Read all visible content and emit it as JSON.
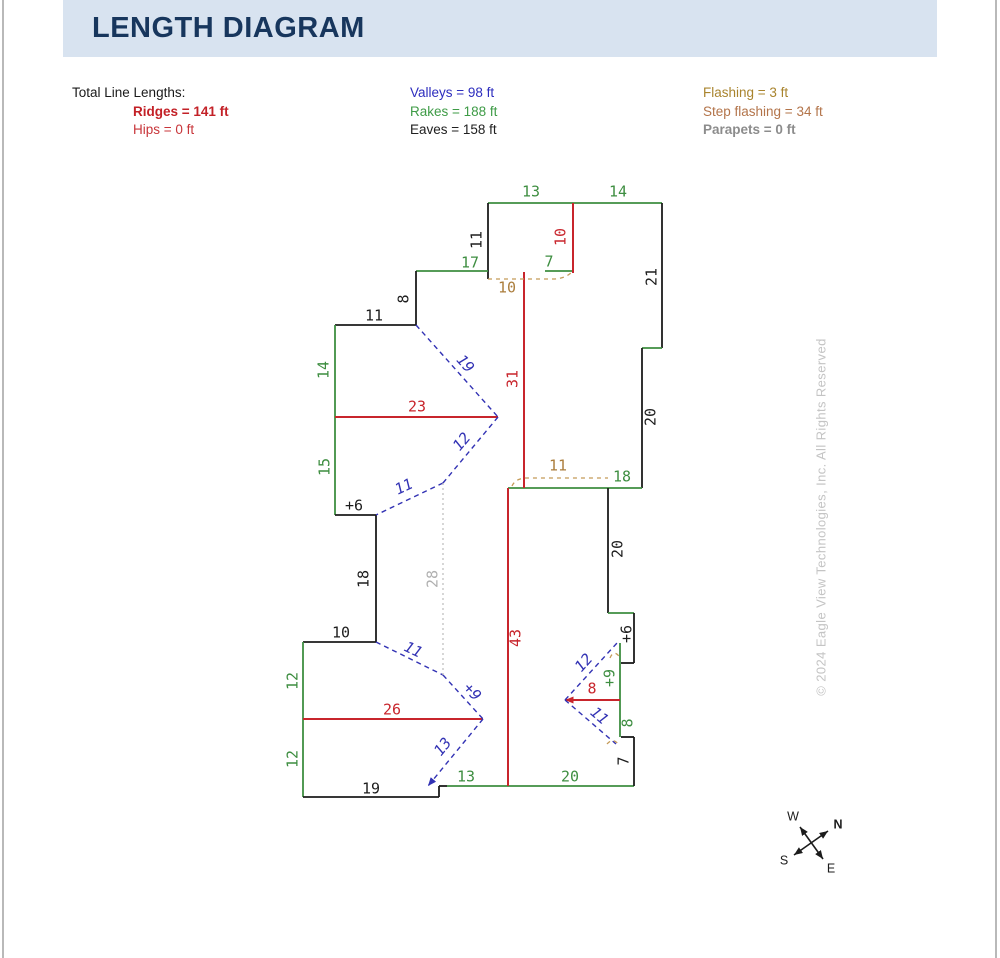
{
  "page": {
    "title": "LENGTH DIAGRAM"
  },
  "legend": {
    "columns": [
      {
        "x": 72,
        "header": "Total Line Lengths:",
        "indent": 61,
        "rows": [
          {
            "text": "Ridges = 141 ft",
            "color": "#c32127",
            "bold": true
          },
          {
            "text": "Hips = 0 ft",
            "color": "#c8353a",
            "bold": false
          }
        ]
      },
      {
        "x": 410,
        "header": "",
        "indent": 0,
        "rows": [
          {
            "text": "Valleys = 98 ft",
            "color": "#2d2dbe",
            "bold": false
          },
          {
            "text": "Rakes = 188 ft",
            "color": "#3e9b46",
            "bold": false
          },
          {
            "text": "Eaves = 158 ft",
            "color": "#202020",
            "bold": false
          }
        ]
      },
      {
        "x": 703,
        "header": "",
        "indent": 0,
        "rows": [
          {
            "text": "Flashing = 3 ft",
            "color": "#a9842e",
            "bold": false
          },
          {
            "text": "Step flashing = 34 ft",
            "color": "#b3744a",
            "bold": false
          },
          {
            "text": "Parapets = 0 ft",
            "color": "#8c8c8c",
            "bold": true
          }
        ]
      }
    ]
  },
  "colors": {
    "lines": {
      "eave": "#1c1c1c",
      "rake": "#3e8e41",
      "ridge": "#c8252c",
      "valley": "#3232b4",
      "step": "#c49a58",
      "hidden": "#bcbcbc",
      "compass": "#1c1c1c"
    },
    "labels": {
      "eave": "#1c1c1c",
      "rake": "#3e8e41",
      "ridge": "#c8252c",
      "valley": "#3232b4",
      "step": "#ab7d3c",
      "hidden": "#b0b0b0",
      "compass": "#1c1c1c",
      "watermark": "#c4c4c4"
    },
    "header_bg": "#d8e3f0",
    "title": "#17365d"
  },
  "diagram": {
    "segments": [
      {
        "kind": "rake",
        "x1": 488,
        "y1": 203,
        "x2": 573,
        "y2": 203
      },
      {
        "kind": "rake",
        "x1": 573,
        "y1": 203,
        "x2": 662,
        "y2": 203
      },
      {
        "kind": "eave",
        "x1": 488,
        "y1": 203,
        "x2": 488,
        "y2": 279
      },
      {
        "kind": "eave",
        "x1": 662,
        "y1": 203,
        "x2": 662,
        "y2": 348
      },
      {
        "kind": "rake",
        "x1": 642,
        "y1": 348,
        "x2": 662,
        "y2": 348
      },
      {
        "kind": "eave",
        "x1": 642,
        "y1": 348,
        "x2": 642,
        "y2": 488
      },
      {
        "kind": "rake",
        "x1": 416,
        "y1": 271,
        "x2": 488,
        "y2": 271
      },
      {
        "kind": "rake",
        "x1": 545,
        "y1": 271,
        "x2": 573,
        "y2": 271
      },
      {
        "kind": "eave",
        "x1": 416,
        "y1": 271,
        "x2": 416,
        "y2": 325
      },
      {
        "kind": "eave",
        "x1": 335,
        "y1": 325,
        "x2": 416,
        "y2": 325
      },
      {
        "kind": "rake",
        "x1": 335,
        "y1": 325,
        "x2": 335,
        "y2": 417
      },
      {
        "kind": "rake",
        "x1": 335,
        "y1": 417,
        "x2": 335,
        "y2": 515
      },
      {
        "kind": "eave",
        "x1": 335,
        "y1": 515,
        "x2": 376,
        "y2": 515
      },
      {
        "kind": "eave",
        "x1": 376,
        "y1": 515,
        "x2": 376,
        "y2": 642
      },
      {
        "kind": "eave",
        "x1": 303,
        "y1": 642,
        "x2": 376,
        "y2": 642
      },
      {
        "kind": "rake",
        "x1": 303,
        "y1": 642,
        "x2": 303,
        "y2": 719
      },
      {
        "kind": "rake",
        "x1": 303,
        "y1": 719,
        "x2": 303,
        "y2": 797
      },
      {
        "kind": "eave",
        "x1": 303,
        "y1": 797,
        "x2": 439,
        "y2": 797
      },
      {
        "kind": "eave",
        "x1": 439,
        "y1": 786,
        "x2": 439,
        "y2": 797
      },
      {
        "kind": "eave",
        "x1": 439,
        "y1": 786,
        "x2": 447,
        "y2": 786
      },
      {
        "kind": "rake",
        "x1": 447,
        "y1": 786,
        "x2": 508,
        "y2": 786
      },
      {
        "kind": "rake",
        "x1": 508,
        "y1": 786,
        "x2": 634,
        "y2": 786
      },
      {
        "kind": "rake",
        "x1": 508,
        "y1": 488,
        "x2": 642,
        "y2": 488
      },
      {
        "kind": "eave",
        "x1": 608,
        "y1": 488,
        "x2": 608,
        "y2": 613
      },
      {
        "kind": "rake",
        "x1": 608,
        "y1": 613,
        "x2": 634,
        "y2": 613
      },
      {
        "kind": "eave",
        "x1": 634,
        "y1": 613,
        "x2": 634,
        "y2": 663
      },
      {
        "kind": "eave",
        "x1": 621,
        "y1": 663,
        "x2": 634,
        "y2": 663
      },
      {
        "kind": "rake",
        "x1": 620,
        "y1": 643,
        "x2": 620,
        "y2": 737
      },
      {
        "kind": "eave",
        "x1": 621,
        "y1": 737,
        "x2": 634,
        "y2": 737
      },
      {
        "kind": "eave",
        "x1": 634,
        "y1": 737,
        "x2": 634,
        "y2": 786
      },
      {
        "kind": "ridge",
        "x1": 573,
        "y1": 203,
        "x2": 573,
        "y2": 273
      },
      {
        "kind": "ridge",
        "x1": 524,
        "y1": 272,
        "x2": 524,
        "y2": 488
      },
      {
        "kind": "ridge",
        "x1": 335,
        "y1": 417,
        "x2": 498,
        "y2": 417
      },
      {
        "kind": "ridge",
        "x1": 508,
        "y1": 488,
        "x2": 508,
        "y2": 786
      },
      {
        "kind": "ridge",
        "x1": 303,
        "y1": 719,
        "x2": 483,
        "y2": 719
      },
      {
        "kind": "ridge",
        "x1": 565,
        "y1": 700,
        "x2": 620,
        "y2": 700,
        "as": true
      },
      {
        "kind": "valley",
        "x1": 416,
        "y1": 325,
        "x2": 498,
        "y2": 417
      },
      {
        "kind": "valley",
        "x1": 498,
        "y1": 417,
        "x2": 443,
        "y2": 483
      },
      {
        "kind": "valley",
        "x1": 443,
        "y1": 483,
        "x2": 376,
        "y2": 515
      },
      {
        "kind": "valley",
        "x1": 376,
        "y1": 642,
        "x2": 443,
        "y2": 675
      },
      {
        "kind": "valley",
        "x1": 443,
        "y1": 675,
        "x2": 483,
        "y2": 719
      },
      {
        "kind": "valley",
        "x1": 483,
        "y1": 719,
        "x2": 428,
        "y2": 786,
        "ae": true
      },
      {
        "kind": "valley",
        "x1": 565,
        "y1": 700,
        "x2": 617,
        "y2": 643
      },
      {
        "kind": "valley",
        "x1": 565,
        "y1": 700,
        "x2": 616,
        "y2": 744
      },
      {
        "kind": "step",
        "path": "M488,279 L555,279 Q566,278 572,272"
      },
      {
        "kind": "step",
        "path": "M512,486 Q515,479 525,478 L608,478"
      },
      {
        "kind": "step",
        "path": "M610,658 Q614,648 621,659"
      },
      {
        "kind": "step",
        "path": "M607,744 Q613,737 619,745"
      },
      {
        "kind": "hidden",
        "x1": 443,
        "y1": 483,
        "x2": 443,
        "y2": 675
      }
    ],
    "labels": [
      {
        "text": "13",
        "x": 531,
        "y": 192,
        "kind": "rake"
      },
      {
        "text": "14",
        "x": 618,
        "y": 192,
        "kind": "rake"
      },
      {
        "text": "11",
        "x": 477,
        "y": 240,
        "kind": "eave",
        "rot": -90
      },
      {
        "text": "10",
        "x": 561,
        "y": 237,
        "kind": "ridge",
        "rot": -90
      },
      {
        "text": "17",
        "x": 470,
        "y": 263,
        "kind": "rake"
      },
      {
        "text": "7",
        "x": 549,
        "y": 262,
        "kind": "rake"
      },
      {
        "text": "10",
        "x": 507,
        "y": 288,
        "kind": "step"
      },
      {
        "text": "21",
        "x": 652,
        "y": 277,
        "kind": "eave",
        "rot": -90
      },
      {
        "text": "8",
        "x": 404,
        "y": 299,
        "kind": "eave",
        "rot": -90
      },
      {
        "text": "11",
        "x": 374,
        "y": 316,
        "kind": "eave"
      },
      {
        "text": "14",
        "x": 324,
        "y": 370,
        "kind": "rake",
        "rot": -90
      },
      {
        "text": "19",
        "x": 465,
        "y": 364,
        "kind": "valley",
        "rot": 48
      },
      {
        "text": "31",
        "x": 513,
        "y": 379,
        "kind": "ridge",
        "rot": -90
      },
      {
        "text": "23",
        "x": 417,
        "y": 407,
        "kind": "ridge"
      },
      {
        "text": "20",
        "x": 651,
        "y": 417,
        "kind": "eave",
        "rot": -90
      },
      {
        "text": "12",
        "x": 462,
        "y": 442,
        "kind": "valley",
        "rot": -50
      },
      {
        "text": "15",
        "x": 325,
        "y": 467,
        "kind": "rake",
        "rot": -90
      },
      {
        "text": "11",
        "x": 404,
        "y": 487,
        "kind": "valley",
        "rot": -25
      },
      {
        "text": "+6",
        "x": 354,
        "y": 506,
        "kind": "eave"
      },
      {
        "text": "11",
        "x": 558,
        "y": 466,
        "kind": "step"
      },
      {
        "text": "18",
        "x": 622,
        "y": 477,
        "kind": "rake"
      },
      {
        "text": "18",
        "x": 364,
        "y": 579,
        "kind": "eave",
        "rot": -90
      },
      {
        "text": "28",
        "x": 433,
        "y": 579,
        "kind": "hidden",
        "rot": -90
      },
      {
        "text": "20",
        "x": 618,
        "y": 549,
        "kind": "eave",
        "rot": -90
      },
      {
        "text": "10",
        "x": 341,
        "y": 633,
        "kind": "eave"
      },
      {
        "text": "43",
        "x": 516,
        "y": 638,
        "kind": "ridge",
        "rot": -90
      },
      {
        "text": "11",
        "x": 413,
        "y": 650,
        "kind": "valley",
        "rot": 26
      },
      {
        "text": "12",
        "x": 293,
        "y": 681,
        "kind": "rake",
        "rot": -90
      },
      {
        "text": "+9",
        "x": 472,
        "y": 692,
        "kind": "valley",
        "rot": 48
      },
      {
        "text": "26",
        "x": 392,
        "y": 710,
        "kind": "ridge"
      },
      {
        "text": "+6",
        "x": 627,
        "y": 634,
        "kind": "eave",
        "rot": -90
      },
      {
        "text": "12",
        "x": 584,
        "y": 663,
        "kind": "valley",
        "rot": -48
      },
      {
        "text": "8",
        "x": 592,
        "y": 689,
        "kind": "ridge"
      },
      {
        "text": "+9",
        "x": 610,
        "y": 678,
        "kind": "rake",
        "rot": -90
      },
      {
        "text": "11",
        "x": 599,
        "y": 716,
        "kind": "valley",
        "rot": 41
      },
      {
        "text": "8",
        "x": 628,
        "y": 723,
        "kind": "rake",
        "rot": -90
      },
      {
        "text": "13",
        "x": 443,
        "y": 747,
        "kind": "valley",
        "rot": -51
      },
      {
        "text": "12",
        "x": 293,
        "y": 759,
        "kind": "rake",
        "rot": -90
      },
      {
        "text": "7",
        "x": 624,
        "y": 761,
        "kind": "eave",
        "rot": -90
      },
      {
        "text": "13",
        "x": 466,
        "y": 777,
        "kind": "rake"
      },
      {
        "text": "20",
        "x": 570,
        "y": 777,
        "kind": "rake"
      },
      {
        "text": "19",
        "x": 371,
        "y": 789,
        "kind": "eave"
      }
    ],
    "watermark": {
      "text": "© 2024 Eagle View Technologies, Inc. All Rights Reserved",
      "x": 822,
      "y": 517,
      "rot": -90
    }
  },
  "compass": {
    "lines": [
      {
        "x1": 800,
        "y1": 827,
        "x2": 823,
        "y2": 859,
        "as": true,
        "ae": true
      },
      {
        "x1": 794,
        "y1": 855,
        "x2": 828,
        "y2": 831,
        "as": true,
        "ae": true
      }
    ],
    "labels": [
      {
        "text": "W",
        "x": 793,
        "y": 817,
        "bold": false
      },
      {
        "text": "N",
        "x": 838,
        "y": 825,
        "bold": true
      },
      {
        "text": "S",
        "x": 784,
        "y": 861,
        "bold": false
      },
      {
        "text": "E",
        "x": 831,
        "y": 869,
        "bold": false
      }
    ]
  }
}
